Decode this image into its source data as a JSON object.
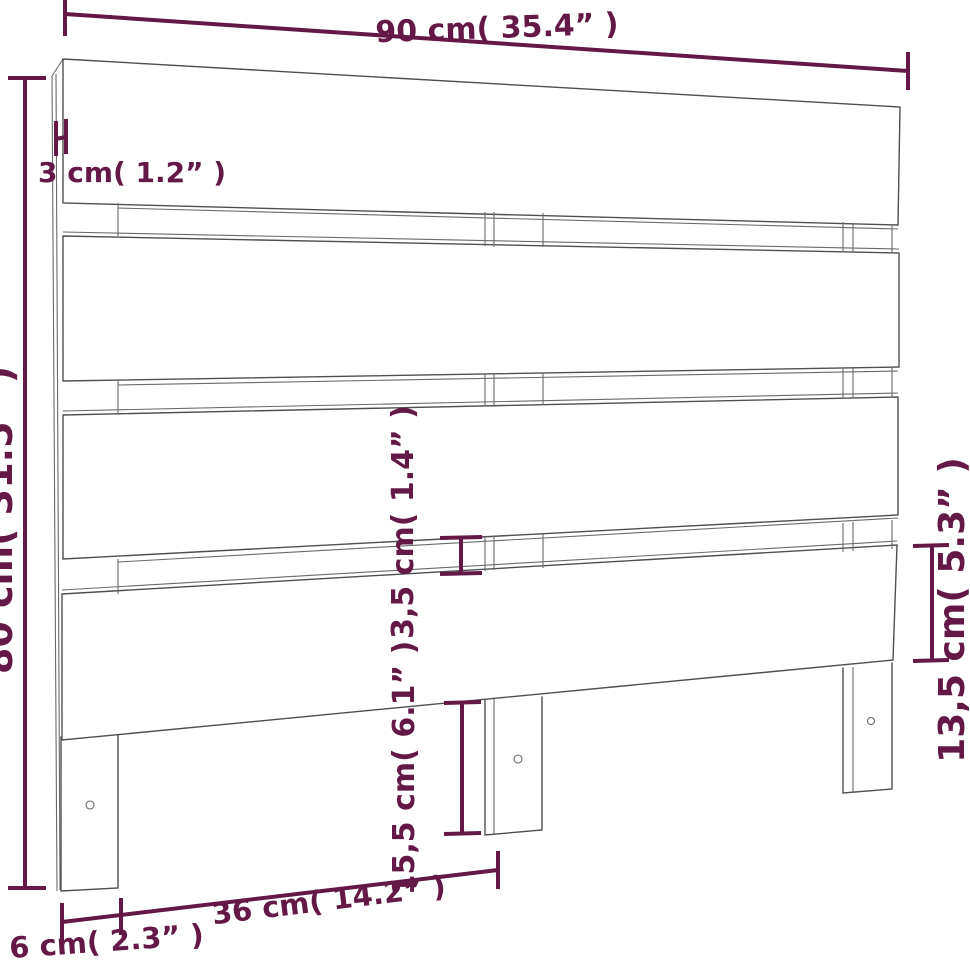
{
  "diagram": {
    "subject": "wooden-headboard-dimension-drawing",
    "colors": {
      "dimension_annotation": "#641846",
      "drawing_line": "#4f4f4f",
      "background": "#ffffff"
    },
    "dimensions": {
      "overall_width": {
        "label": "90 cm( 35.4” )"
      },
      "board_thickness": {
        "label": "3 cm( 1.2” )"
      },
      "overall_height": {
        "label": "80 cm( 31.5” )"
      },
      "slat_gap": {
        "label": "3,5 cm( 1.4” )"
      },
      "leg_below_height": {
        "label": "15,5 cm( 6.1” )"
      },
      "bottom_slat_height": {
        "label": "13,5 cm( 5.3” )"
      },
      "leg_spacing": {
        "label": "36 cm( 14.2” )"
      },
      "leg_width": {
        "label": "6 cm( 2.3” )"
      }
    }
  }
}
